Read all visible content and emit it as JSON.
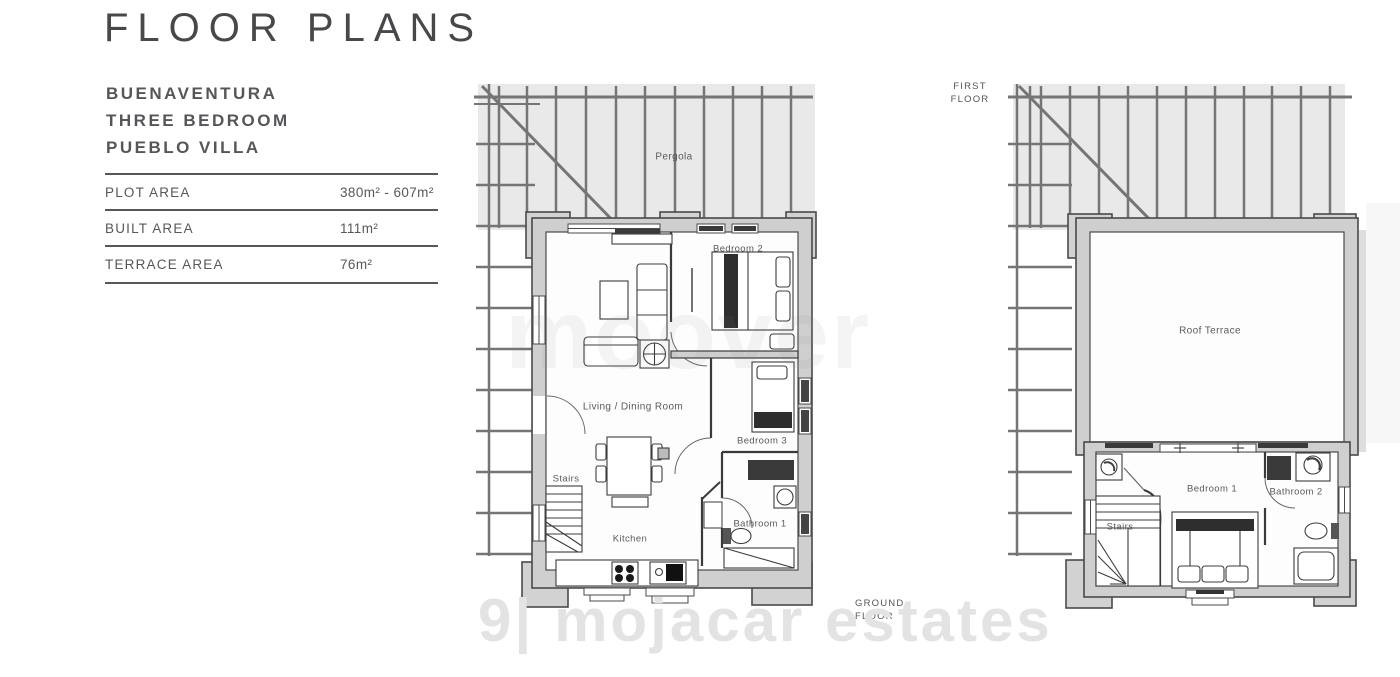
{
  "header": {
    "title": "FLOOR PLANS",
    "subtitle_lines": [
      "BUENAVENTURA",
      "THREE BEDROOM",
      "PUEBLO VILLA"
    ]
  },
  "specs": {
    "rows": [
      {
        "label": "PLOT AREA",
        "value": "380m² - 607m²"
      },
      {
        "label": "BUILT AREA",
        "value": "111m²"
      },
      {
        "label": "TERRACE AREA",
        "value": "76m²"
      }
    ]
  },
  "ground_floor": {
    "title_lines": [
      "GROUND",
      "FLOOR"
    ],
    "labels": {
      "pergola": "Pergola",
      "bedroom2": "Bedroom 2",
      "living": "Living / Dining Room",
      "stairs": "Stairs",
      "kitchen": "Kitchen",
      "bedroom3": "Bedroom 3",
      "bathroom1": "Bathroom 1"
    }
  },
  "first_floor": {
    "title_lines": [
      "FIRST",
      "FLOOR"
    ],
    "labels": {
      "roof_terrace": "Roof Terrace",
      "bedroom1": "Bedroom 1",
      "bathroom2": "Bathroom 2",
      "stairs": "Stairs"
    }
  },
  "watermarks": {
    "center": "moover",
    "bottom_logo": "9|",
    "bottom_text": "mojacar estates"
  },
  "colors": {
    "wall_fill": "#cfcfcf",
    "pillar_fill": "#d2d2d2",
    "pergola_fill": "#e9e9e9",
    "floor_fill": "#fdfdfd",
    "pergola_bar": "#757575",
    "wall_line": "#4a4a4a",
    "furniture_line": "#3c3c3c",
    "dark_fill": "#2e2e2e",
    "label_text": "#5a5a5a"
  }
}
